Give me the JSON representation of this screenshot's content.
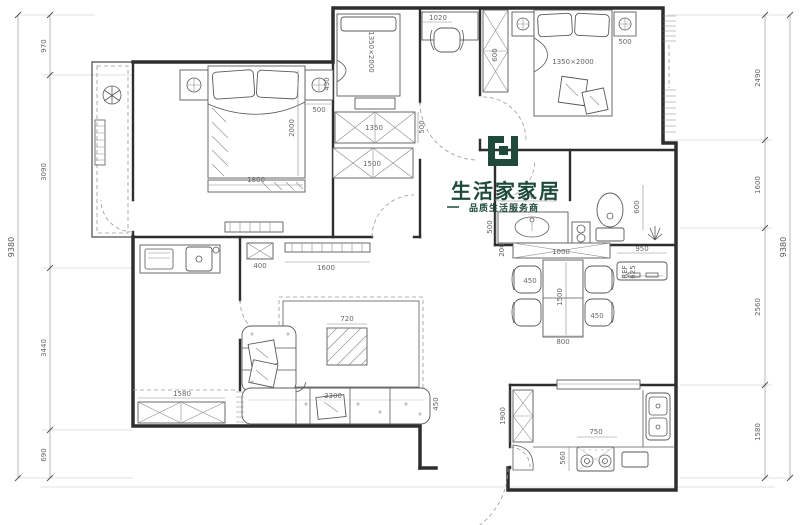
{
  "logo": {
    "title": "生活家家居",
    "tagline": "品质生活服务商",
    "brand_color": "#1d4a3a"
  },
  "dims": {
    "left_total": "9380",
    "left": [
      "970",
      "3090",
      "3440",
      "690"
    ],
    "right_total": "9380",
    "right": [
      "2490",
      "1600",
      "2560",
      "1580"
    ]
  },
  "labels": {
    "bedroom2": {
      "bed_width": "1800",
      "bed_length": "2000",
      "nightstand_width": "500",
      "nightstand_depth": "450"
    },
    "study": {
      "bed_size": "1350×2000",
      "desk_width": "1020",
      "wardrobe_a": "1350",
      "wardrobe_a_depth": "500",
      "wardrobe_b": "1500"
    },
    "master": {
      "bed_size": "1350×2000",
      "wardrobe_depth": "600",
      "nightstand_width": "500"
    },
    "bathroom": {
      "vanity_width": "870",
      "vanity_depth": "500",
      "toilet_zone": "600"
    },
    "dining": {
      "sideboard_width": "1000",
      "sideboard_depth": "200",
      "fridge_width": "950",
      "fridge_label": "REF",
      "fridge_depth": "625",
      "chair_left": "450",
      "chair_right": "450",
      "table_length": "1500",
      "table_width": "800"
    },
    "kitchen": {
      "tall_unit": "1900",
      "stove_width": "750",
      "counter_depth": "560"
    },
    "living": {
      "coffee_table": "720",
      "sofa_length": "3300",
      "sofa_depth": "450",
      "tv_cabinet": "1600",
      "side_cabinet": "400"
    },
    "balcony": {
      "cabinet_width": "1580"
    }
  }
}
